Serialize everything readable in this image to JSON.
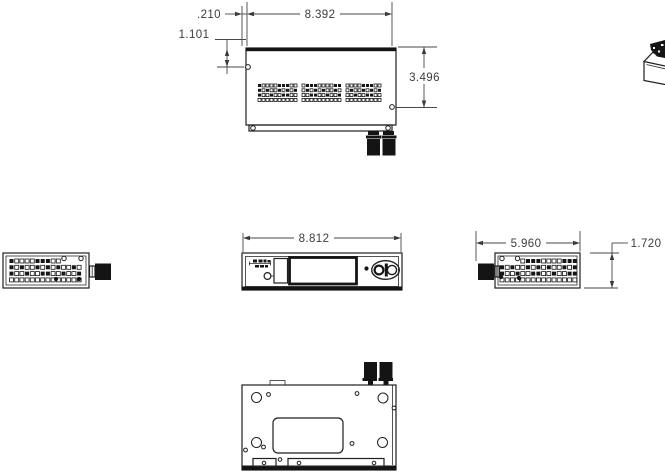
{
  "drawing": {
    "colors": {
      "ink": "#1f1f1f",
      "paper": "#ffffff"
    },
    "views": {
      "top": {
        "dim_inset": ".210",
        "dim_width": "8.392",
        "dim_hole_drop": "1.101",
        "dim_height": "3.496"
      },
      "front": {
        "dim_width": "8.812"
      },
      "right": {
        "dim_depth": "5.960",
        "dim_height": "1.720"
      }
    }
  }
}
